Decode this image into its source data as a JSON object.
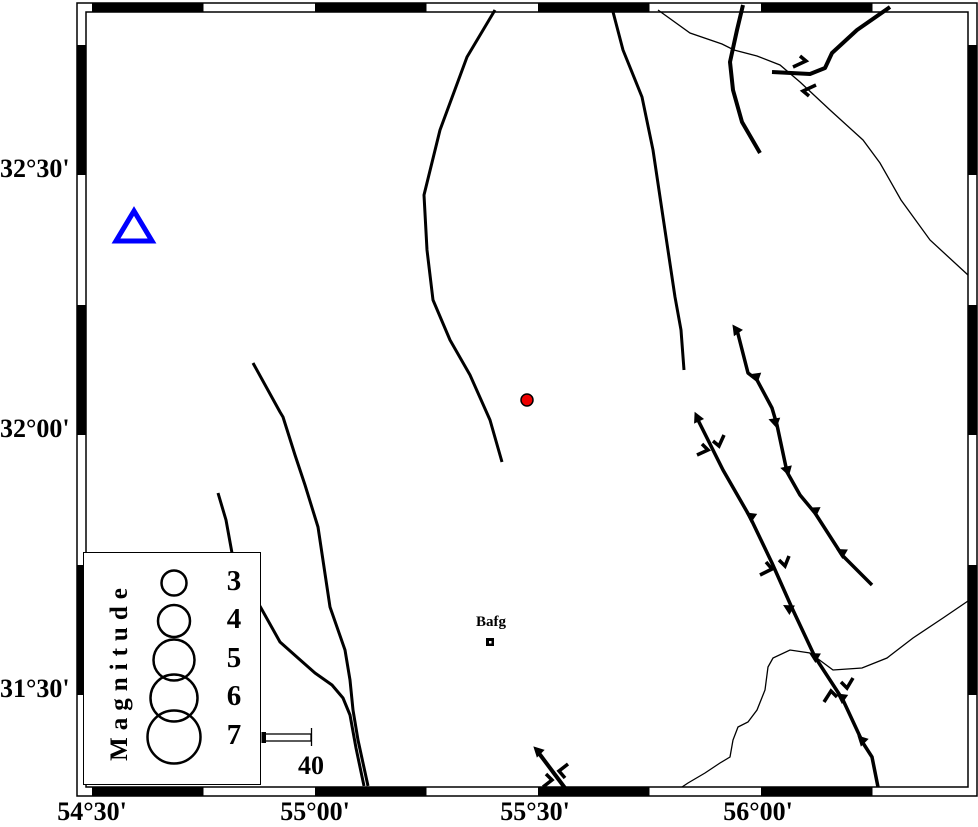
{
  "map": {
    "frame": {
      "outer": [
        77,
        3,
        977,
        796
      ],
      "inner": [
        86,
        12,
        968,
        787
      ],
      "black_x": [
        [
          92,
          203.5
        ],
        [
          315,
          426.5
        ],
        [
          538,
          649.5
        ],
        [
          761,
          872.5
        ]
      ],
      "black_y": [
        [
          45,
          175
        ],
        [
          305,
          435
        ],
        [
          565,
          695
        ]
      ]
    },
    "axis_labels": {
      "x": [
        {
          "text": "54°30'",
          "cx": 92
        },
        {
          "text": "55°00'",
          "cx": 315
        },
        {
          "text": "55°30'",
          "cx": 535
        },
        {
          "text": "56°00'",
          "cx": 758
        }
      ],
      "y": [
        {
          "text": "32°30'",
          "cy": 170
        },
        {
          "text": "32°00'",
          "cy": 430
        },
        {
          "text": "31°30'",
          "cy": 690
        }
      ]
    },
    "colors": {
      "station": "#0000ff",
      "epicenter": "#ee0000",
      "line": "#000000"
    },
    "station": {
      "points": "134,211 116,241 152,241",
      "stroke_width": 5
    },
    "epicenter": {
      "cx": 527,
      "cy": 400,
      "r": 6
    },
    "town": {
      "name": "Bafg",
      "label_cx": 491,
      "label_top": 614,
      "square": [
        486,
        638,
        8
      ]
    },
    "legend": {
      "title": "Magnitude",
      "circle_cx": 90,
      "label_cx": 150,
      "entries": [
        {
          "label": "3",
          "r": 12.5,
          "cy": 30
        },
        {
          "label": "4",
          "r": 16,
          "cy": 68
        },
        {
          "label": "5",
          "r": 20.5,
          "cy": 107
        },
        {
          "label": "6",
          "r": 23.5,
          "cy": 145
        },
        {
          "label": "7",
          "r": 26.5,
          "cy": 184
        }
      ]
    },
    "scale_bar": {
      "label": "40",
      "bar": [
        264,
        734,
        47,
        7
      ],
      "cap": [
        261.5,
        732,
        4.5,
        11
      ],
      "tick": [
        311.5,
        728,
        746
      ],
      "label_cx": 311,
      "label_top": 751
    },
    "geometry": {
      "faults": [
        {
          "w": 3,
          "pts": [
            [
              495,
              10
            ],
            [
              467,
              57
            ],
            [
              440,
              130
            ],
            [
              424,
              195
            ],
            [
              427,
              250
            ],
            [
              433,
              300
            ],
            [
              450,
              340
            ],
            [
              470,
              375
            ],
            [
              490,
              420
            ],
            [
              502,
              462
            ]
          ]
        },
        {
          "w": 3,
          "pts": [
            [
              612,
              8
            ],
            [
              623,
              50
            ],
            [
              642,
              97
            ],
            [
              653,
              150
            ],
            [
              663,
              217
            ],
            [
              675,
              297
            ],
            [
              681,
              330
            ],
            [
              684,
              370
            ]
          ]
        },
        {
          "w": 4,
          "pts": [
            [
              743,
              5
            ],
            [
              737,
              30
            ],
            [
              730,
              62
            ],
            [
              733,
              90
            ],
            [
              742,
              122
            ],
            [
              760,
              153
            ]
          ]
        },
        {
          "w": 4,
          "pts": [
            [
              890,
              7
            ],
            [
              857,
              30
            ],
            [
              832,
              53
            ],
            [
              825,
              68
            ],
            [
              810,
              74
            ],
            [
              772,
              72
            ]
          ]
        },
        {
          "w": 3,
          "pts": [
            [
              253,
              363
            ],
            [
              280,
              412
            ],
            [
              283,
              417
            ],
            [
              295,
              455
            ],
            [
              305,
              485
            ],
            [
              318,
              527
            ],
            [
              330,
              607
            ],
            [
              345,
              650
            ],
            [
              350,
              680
            ],
            [
              353,
              710
            ],
            [
              358,
              740
            ],
            [
              368,
              786
            ]
          ]
        },
        {
          "w": 3,
          "pts": [
            [
              218,
              493
            ],
            [
              226,
              520
            ],
            [
              232,
              553
            ],
            [
              245,
              580
            ],
            [
              261,
              608
            ],
            [
              280,
              642
            ],
            [
              298,
              658
            ],
            [
              315,
              673
            ],
            [
              332,
              685
            ],
            [
              343,
              698
            ],
            [
              350,
              715
            ],
            [
              356,
              748
            ],
            [
              364,
              786
            ]
          ]
        },
        {
          "w": 3.5,
          "pts": [
            [
              737,
              330
            ],
            [
              748,
              373
            ],
            [
              757,
              380
            ],
            [
              772,
              408
            ],
            [
              777,
              425
            ],
            [
              787,
              472
            ],
            [
              800,
              495
            ],
            [
              815,
              513
            ],
            [
              842,
              555
            ],
            [
              872,
              585
            ]
          ]
        },
        {
          "w": 3.5,
          "pts": [
            [
              698,
              420
            ],
            [
              723,
              470
            ],
            [
              750,
              517
            ],
            [
              772,
              563
            ],
            [
              792,
              608
            ],
            [
              815,
              657
            ],
            [
              843,
              700
            ],
            [
              863,
              743
            ],
            [
              872,
              757
            ],
            [
              878,
              787
            ]
          ]
        },
        {
          "w": 4,
          "pts": [
            [
              538,
              752
            ],
            [
              565,
              788
            ]
          ]
        }
      ],
      "rivers": [
        [
          [
            658,
            10
          ],
          [
            690,
            33
          ],
          [
            722,
            44
          ],
          [
            734,
            50
          ],
          [
            757,
            56
          ],
          [
            780,
            65
          ],
          [
            800,
            82
          ],
          [
            830,
            110
          ],
          [
            863,
            140
          ],
          [
            880,
            163
          ],
          [
            901,
            200
          ],
          [
            930,
            240
          ],
          [
            968,
            275
          ]
        ],
        [
          [
            968,
            601
          ],
          [
            943,
            618
          ],
          [
            913,
            638
          ],
          [
            887,
            658
          ],
          [
            862,
            668
          ],
          [
            833,
            670
          ],
          [
            810,
            653
          ],
          [
            790,
            650
          ],
          [
            773,
            658
          ],
          [
            768,
            667
          ],
          [
            765,
            690
          ],
          [
            757,
            710
          ],
          [
            748,
            722
          ],
          [
            738,
            727
          ],
          [
            733,
            740
          ],
          [
            730,
            757
          ],
          [
            720,
            763
          ],
          [
            705,
            773
          ],
          [
            688,
            783
          ],
          [
            682,
            787
          ]
        ]
      ],
      "teeth": [
        [
          737,
          331,
          -35
        ],
        [
          757,
          377,
          -70
        ],
        [
          776,
          422,
          -70
        ],
        [
          788,
          470,
          -75
        ],
        [
          816,
          511,
          -65
        ],
        [
          843,
          553,
          -60
        ],
        [
          698,
          419,
          -25
        ],
        [
          752,
          517,
          -55
        ],
        [
          790,
          609,
          -60
        ],
        [
          816,
          657,
          -60
        ],
        [
          843,
          698,
          -55
        ],
        [
          863,
          741,
          -45
        ],
        [
          539,
          752,
          -45
        ]
      ],
      "ss_marks": [
        [
          [
            793,
            67
          ],
          [
            806,
            61
          ],
          [
            800,
            56
          ]
        ],
        [
          [
            816,
            85
          ],
          [
            803,
            91
          ],
          [
            809,
            96
          ]
        ],
        [
          [
            724,
            435
          ],
          [
            719,
            446
          ],
          [
            713,
            441
          ]
        ],
        [
          [
            697,
            455
          ],
          [
            708,
            450
          ],
          [
            702,
            444
          ]
        ],
        [
          [
            789,
            556
          ],
          [
            785,
            566
          ],
          [
            779,
            560
          ]
        ],
        [
          [
            760,
            575
          ],
          [
            772,
            569
          ],
          [
            766,
            562
          ]
        ],
        [
          [
            853,
            678
          ],
          [
            847,
            688
          ],
          [
            841,
            682
          ]
        ],
        [
          [
            824,
            702
          ],
          [
            831,
            691
          ],
          [
            837,
            697
          ]
        ],
        [
          [
            568,
            764
          ],
          [
            559,
            771
          ],
          [
            565,
            778
          ]
        ],
        [
          [
            543,
            787
          ],
          [
            552,
            780
          ],
          [
            546,
            774
          ]
        ]
      ]
    }
  }
}
